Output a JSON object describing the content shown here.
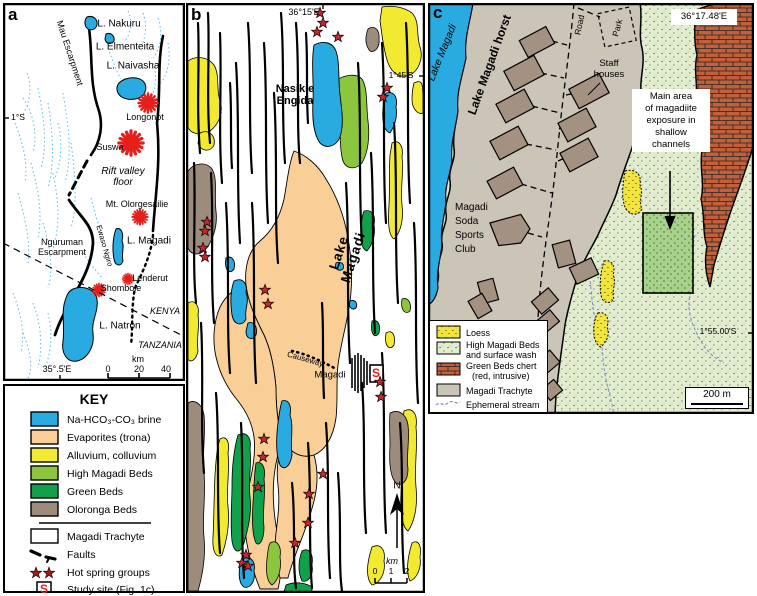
{
  "figure_title": "Lake Magadi geological maps",
  "colors": {
    "brine_blue": "#29ABE2",
    "trona_tan": "#F9CF97",
    "alluvium_yellow": "#F2EA30",
    "high_magadi_green": "#8CC63E",
    "green_beds": "#12A14B",
    "oloronga_brown": "#9D8B7C",
    "trachyte_gray": "#CBC5B8",
    "chert_red": "#C2603C",
    "volcano_star_red": "#E3201B",
    "hot_spring_red": "#C1272D",
    "key_star_maroon": "#9E1B17",
    "stream_blue": "#7B87C9",
    "study_area_green": "#A8D18C"
  },
  "panel_a": {
    "letter": "a",
    "l_nakuru": "L. Nakuru",
    "l_elmenteita": "L. Elmenteita",
    "l_naivasha": "L. Naivasha",
    "longonot": "Longonot",
    "suswa": "Suswa",
    "rift_line1": "Rift valley",
    "rift_line2": "floor",
    "mau": "Mau Escarpment",
    "olorgesailie": "Mt. Olorgesailie",
    "l_magadi": "L. Magadi",
    "nguruman_line1": "Nguruman",
    "nguruman_line2": "Escarpment",
    "ewaso": "Ewaso Ngiro",
    "lenderut": "Lenderut",
    "shombole": "Shombole",
    "kenya": "KENYA",
    "tanzania": "TANZANIA",
    "l_natron": "L. Natron",
    "lat": "1°S",
    "lon": "35°.5'E",
    "scale_unit": "km",
    "scale_0": "0",
    "scale_20": "20",
    "scale_40": "40"
  },
  "key": {
    "title": "KEY",
    "swatches": [
      {
        "label": "Na-HCO₃-CO₃ brine",
        "color": "#29ABE2"
      },
      {
        "label": "Evaporites (trona)",
        "color": "#F9CF97"
      },
      {
        "label": "Alluvium, colluvium",
        "color": "#F2EA30"
      },
      {
        "label": "High Magadi Beds",
        "color": "#8CC63E"
      },
      {
        "label": "Green Beds",
        "color": "#12A14B"
      },
      {
        "label": "Oloronga Beds",
        "color": "#9D8B7C"
      }
    ],
    "trachyte": "Magadi Trachyte",
    "faults": "Faults",
    "hot_springs": "Hot spring groups",
    "study_site": "Study site (Fig. 1c)",
    "study_letter": "S"
  },
  "panel_b": {
    "letter": "b",
    "lon": "36°15'E",
    "lat": "1°45'S",
    "nasikie_line1": "Nasikie",
    "nasikie_line2": "Engida",
    "lake_line1": "Lake",
    "lake_line2": "Magadi",
    "causeway": "Causeway",
    "town": "Magadi",
    "study_letter": "S",
    "north": "N",
    "scale_unit": "km",
    "scale_0": "0",
    "scale_1": "1",
    "scale_2": "2"
  },
  "panel_c": {
    "letter": "c",
    "lake": "Lake Magadi",
    "horst": "Lake Magadi horst",
    "road": "Road",
    "park": "Park",
    "staff_line1": "Staff",
    "staff_line2": "houses",
    "lon": "36°17.48'E",
    "lat": "1°55.00'S",
    "annotation_lines": [
      "Main area",
      "of magadiite",
      "exposure in",
      "shallow",
      "channels"
    ],
    "club_lines": [
      "Magadi",
      "Soda",
      "Sports",
      "Club"
    ],
    "legend": {
      "loess": "Loess",
      "hmb_line1": "High Magadi Beds",
      "hmb_line2": "and surface wash",
      "chert_line1": "Green Beds chert",
      "chert_line2": "(red, intrusive)",
      "trachyte": "Magadi Trachyte",
      "stream": "Ephemeral stream"
    },
    "scale": "200 m"
  }
}
